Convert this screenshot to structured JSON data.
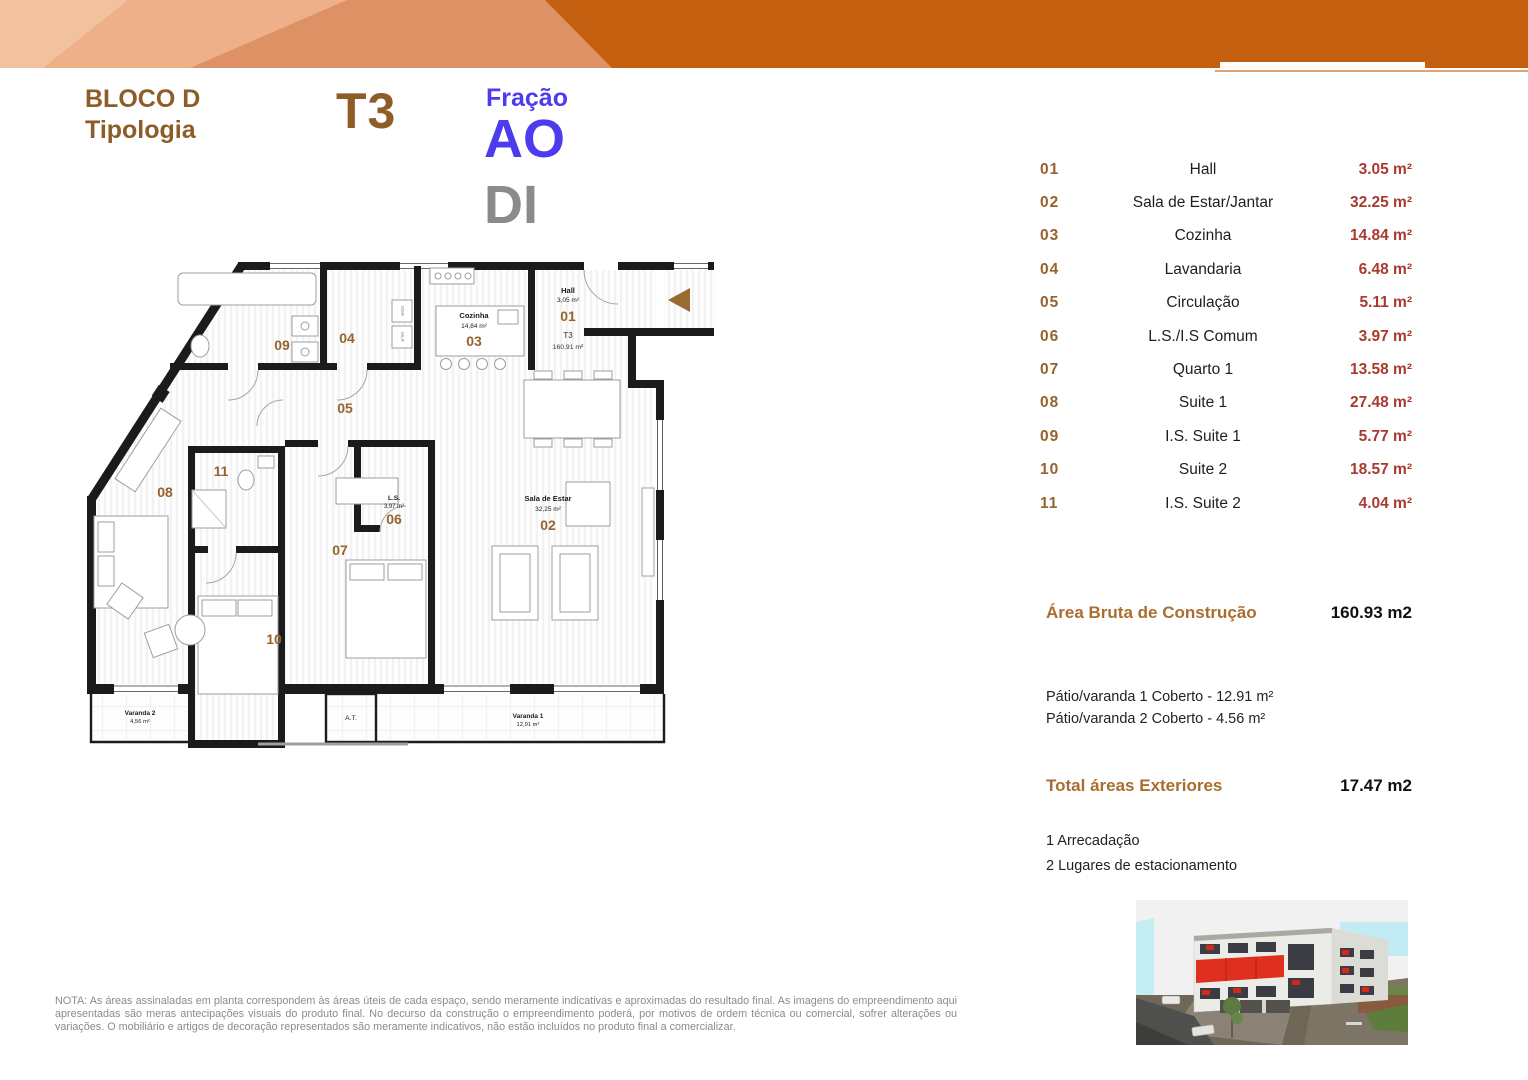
{
  "header": {
    "block_line1": "BLOCO D",
    "block_line2": "Tipologia",
    "typology": "T3",
    "fraction_label": "Fração",
    "fraction_code": "AO",
    "fraction_code2": "DI"
  },
  "room_table": {
    "rows": [
      {
        "num": "01",
        "name": "Hall",
        "area": "3.05 m²"
      },
      {
        "num": "02",
        "name": "Sala de Estar/Jantar",
        "area": "32.25 m²"
      },
      {
        "num": "03",
        "name": "Cozinha",
        "area": "14.84 m²"
      },
      {
        "num": "04",
        "name": "Lavandaria",
        "area": "6.48 m²"
      },
      {
        "num": "05",
        "name": "Circulação",
        "area": "5.11 m²"
      },
      {
        "num": "06",
        "name": "L.S./I.S Comum",
        "area": "3.97 m²"
      },
      {
        "num": "07",
        "name": "Quarto 1",
        "area": "13.58 m²"
      },
      {
        "num": "08",
        "name": "Suite 1",
        "area": "27.48 m²"
      },
      {
        "num": "09",
        "name": "I.S. Suite 1",
        "area": "5.77 m²"
      },
      {
        "num": "10",
        "name": "Suite 2",
        "area": "18.57 m²"
      },
      {
        "num": "11",
        "name": "I.S. Suite 2",
        "area": "4.04 m²"
      }
    ]
  },
  "summary": {
    "gross_label": "Área Bruta de Construção",
    "gross_value": "160.93 m2",
    "patio1": "Pátio/varanda 1 Coberto - 12.91 m²",
    "patio2": "Pátio/varanda 2 Coberto - 4.56 m²",
    "exterior_label": "Total áreas Exteriores",
    "exterior_value": "17.47 m2",
    "storage": "1 Arrecadação",
    "parking": "2 Lugares de estacionamento"
  },
  "plan": {
    "num01": "01",
    "num02": "02",
    "num03": "03",
    "num04": "04",
    "num05": "05",
    "num06": "06",
    "num07": "07",
    "num08": "08",
    "num09": "09",
    "num10": "10",
    "num11": "11",
    "hall_name": "Hall",
    "hall_area": "3,05 m²",
    "t3": "T3",
    "t3_area": "160,91 m²",
    "kitchen_name": "Cozinha",
    "kitchen_area": "14,84 m²",
    "living_name": "Sala de Estar",
    "living_area": "32,25 m²",
    "ls_name": "L.S.",
    "ls_area": "3,97 m²",
    "varanda1_name": "Varanda 1",
    "varanda1_area": "12,91 m²",
    "varanda2_name": "Varanda 2",
    "varanda2_area": "4,56 m²",
    "at": "A.T.",
    "msr": "MSR",
    "mlr": "MLR"
  },
  "colors": {
    "banner_dark": "#c45f10",
    "banner_mid": "#de9164",
    "banner_light": "#eeb089",
    "banner_lightest": "#f2c19e",
    "brown_title": "#8d5c27",
    "brown_number": "#96632e",
    "red_area": "#a83a2e",
    "blue_fraction": "#4c3cee",
    "gray_code": "#8b8b8b"
  },
  "disclaimer": {
    "text": "NOTA: As áreas assinaladas em planta correspondem às áreas úteis de cada espaço, sendo meramente indicativas e aproximadas do resultado final. As imagens do empreendimento aqui apresentadas são meras antecipações visuais do produto final. No decurso da construção o empreendimento poderá, por motivos de ordem técnica ou comercial, sofrer alterações ou variações. O mobiliário e artigos de decoração representados são meramente indicativos, não estão incluídos no produto final a comercializar."
  }
}
